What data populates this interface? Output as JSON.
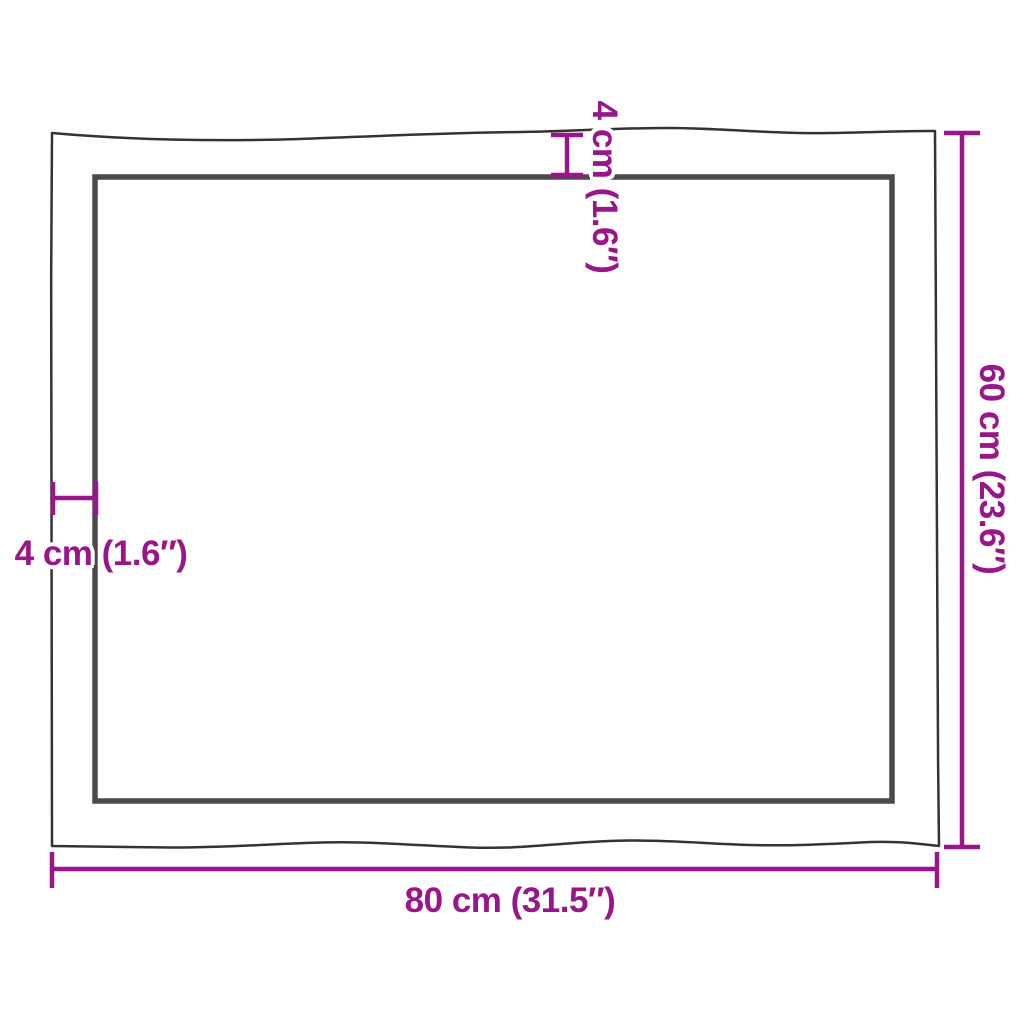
{
  "labels": {
    "width": "80 cm (31.5″)",
    "height": "60 cm (23.6″)",
    "thickness_top": "4 cm (1.6″)",
    "thickness_side": "4 cm (1.6″)"
  },
  "values": {
    "width_cm": 80,
    "width_inch": 31.5,
    "height_cm": 60,
    "height_inch": 23.6,
    "thickness_cm": 4,
    "thickness_inch": 1.6
  },
  "colors": {
    "dimension_accent": "#99158A",
    "outline": "#333333",
    "inner_edge": "#4A4A4A",
    "background": "#FFFFFF"
  }
}
